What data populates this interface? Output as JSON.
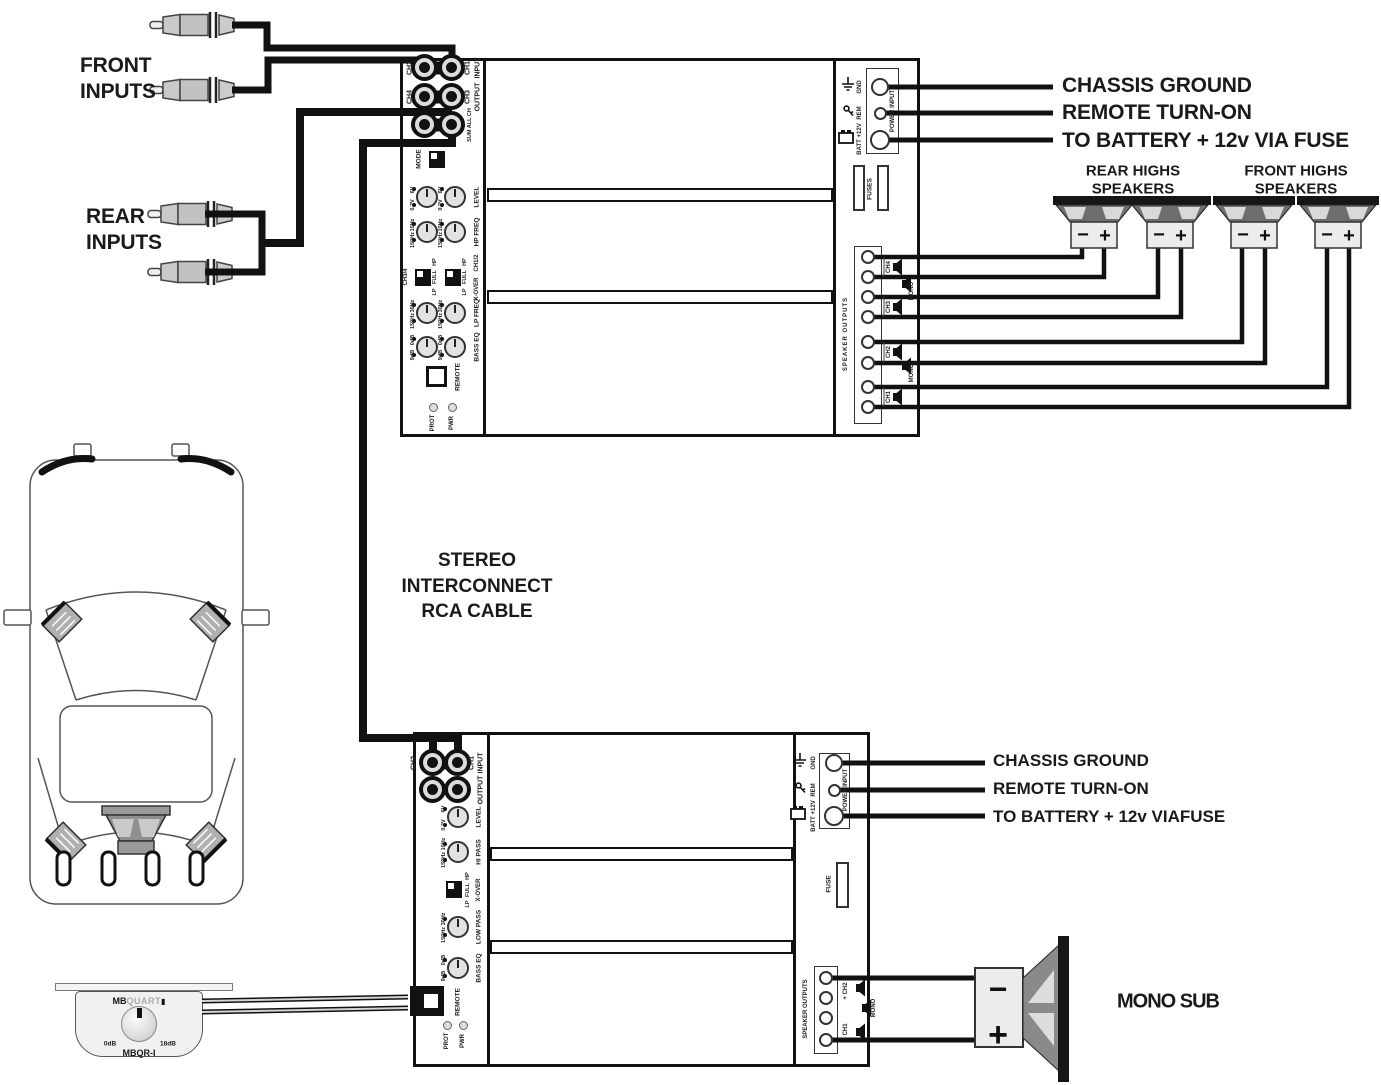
{
  "labels": {
    "front_inputs": [
      "FRONT",
      "INPUTS"
    ],
    "rear_inputs": [
      "REAR",
      "INPUTS"
    ],
    "interconnect": [
      "STEREO",
      "INTERCONNECT",
      "RCA CABLE"
    ],
    "mono_sub": "MONO SUB",
    "rear_highs": [
      "REAR HIGHS",
      "SPEAKERS"
    ],
    "front_highs": [
      "FRONT HIGHS",
      "SPEAKERS"
    ]
  },
  "top_callouts": {
    "gnd": "CHASSIS GROUND",
    "rem": "REMOTE TURN-ON",
    "batt": "TO BATTERY + 12v VIA FUSE"
  },
  "bottom_callouts": {
    "gnd": "CHASSIS GROUND",
    "rem": "REMOTE TURN-ON",
    "batt": "TO BATTERY + 12v VIAFUSE"
  },
  "top_amp": {
    "io": {
      "ch2": "CH2",
      "ch1": "CH1",
      "input": "INPUT",
      "ch4": "CH4",
      "ch3": "CH3",
      "output": "OUTPUT",
      "sum": "SUM ALL CH",
      "mode": "MODE"
    },
    "cols": {
      "left": "CH3/4",
      "right": "CH1/2"
    },
    "knobs": {
      "level": {
        "label": "LEVEL",
        "t1": "6V",
        "t2": "0.2V"
      },
      "hpfreq": {
        "label": "HP FREQ",
        "t1": "10Hz",
        "t2": "150Hz"
      },
      "lpfreq": {
        "label": "LP FREQ",
        "t1": "30Hz",
        "t2": "150Hz"
      },
      "basseq": {
        "label": "BASS EQ",
        "t1": "0dB",
        "t2": "9dB"
      }
    },
    "xover": {
      "label": "X-OVER",
      "hp": "HP",
      "full": "FULL",
      "lp": "LP"
    },
    "remote": "REMOTE",
    "pwr": "PWR",
    "prot": "PROT",
    "power": {
      "title": "POWER INPUT",
      "gnd": "GND",
      "rem": "REM",
      "batt": "BATT +12V"
    },
    "fuses": "FUSES",
    "outputs": {
      "title": "SPEAKER OUTPUTS",
      "ch4": "CH4",
      "mono1": "MONO",
      "ch3": "CH3",
      "ch2": "CH2",
      "mono2": "MONO",
      "ch1": "CH1"
    }
  },
  "bottom_amp": {
    "io": {
      "ch2": "CH2",
      "ch1": "CH1",
      "input": "INPUT",
      "output": "OUTPUT"
    },
    "knobs": {
      "level": {
        "label": "LEVEL",
        "t1": "6V",
        "t2": "0.2V"
      },
      "hipass": {
        "label": "HI PASS",
        "t1": "10Hz",
        "t2": "150Hz"
      },
      "lowpass": {
        "label": "LOW PASS",
        "t1": "30Hz",
        "t2": "150Hz"
      },
      "basseq": {
        "label": "BASS EQ",
        "t1": "0dB",
        "t2": "9dB"
      }
    },
    "xover": {
      "label": "X-OVER",
      "hp": "HP",
      "full": "FULL",
      "lp": "LP"
    },
    "remote": "REMOTE",
    "pwr": "PWR",
    "prot": "PROT",
    "power": {
      "title": "POWER INPUT",
      "gnd": "GND",
      "rem": "REM",
      "batt": "BATT +12V"
    },
    "fuse": "FUSE",
    "outputs": {
      "title": "SPEAKER OUTPUTS",
      "ch2": "+ CH2",
      "mono": "MONO",
      "ch1": "− CH1"
    }
  },
  "speaker_terms": {
    "minus": "−",
    "plus": "+"
  },
  "sub_terms": {
    "minus": "−",
    "plus": "+"
  },
  "remote_ctrl": {
    "brand_bold": "MB",
    "brand_light": "QUART",
    "cube": "▮",
    "left": "0dB",
    "right": "18dB",
    "model": "MBQR-I"
  }
}
